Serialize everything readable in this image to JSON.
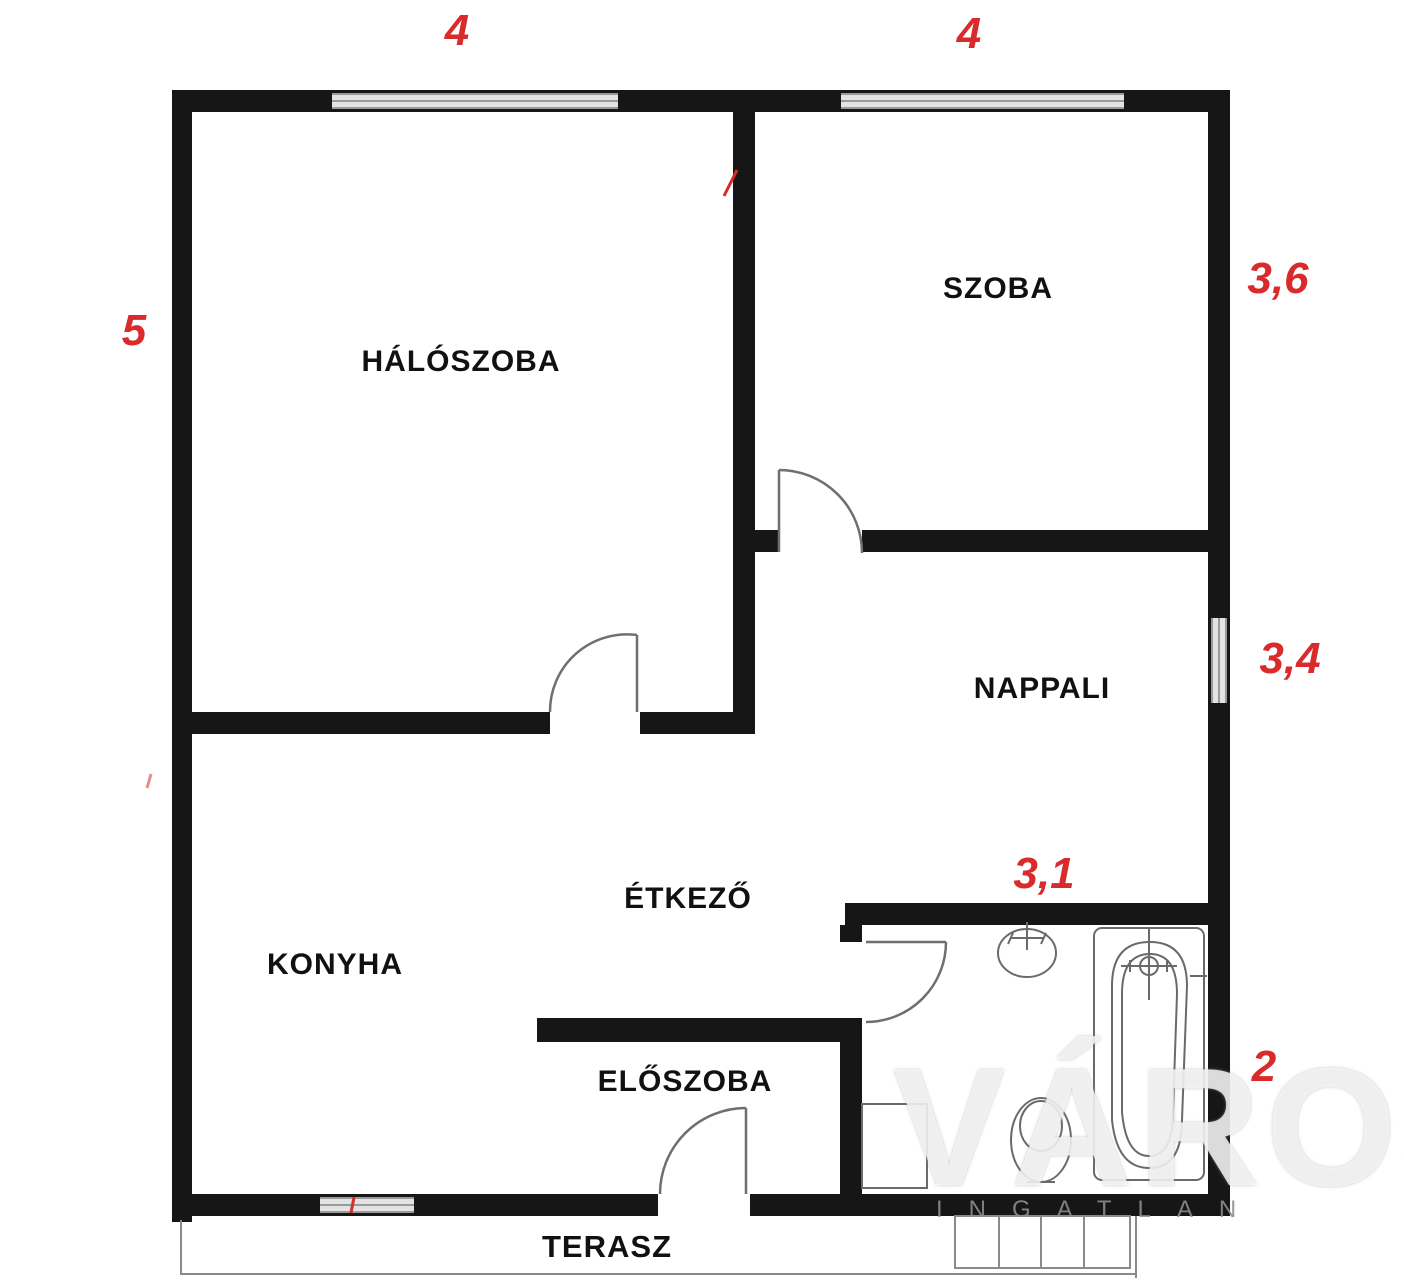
{
  "rooms": {
    "haloszoba": "HÁLÓSZOBA",
    "szoba": "SZOBA",
    "nappali": "NAPPALI",
    "etkezo": "ÉTKEZŐ",
    "konyha": "KONYHA",
    "eloszoba": "ELŐSZOBA",
    "terasz": "TERASZ"
  },
  "dimensions": {
    "top_left": "4",
    "top_right": "4",
    "left": "5",
    "right_top": "3,6",
    "right_mid": "3,4",
    "bath_top": "3,1",
    "right_bottom": "2"
  },
  "watermark": {
    "big": "VÁROS",
    "small": "INGATLAN"
  },
  "colors": {
    "wall": "#161616",
    "dimension_red": "#d92b2b",
    "fixture_gray": "#6a6a6a",
    "window_fill": "#e3e3e3",
    "window_edge": "#9a9a9a"
  }
}
